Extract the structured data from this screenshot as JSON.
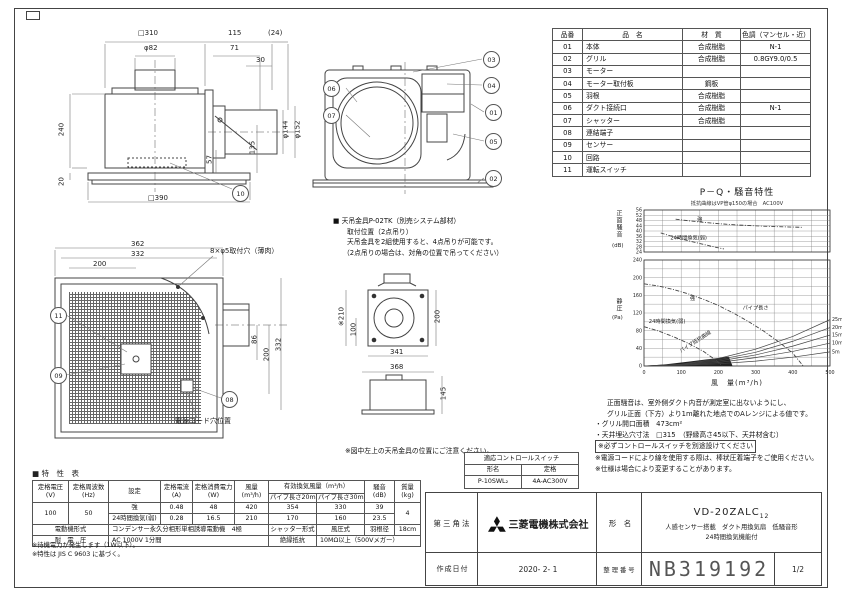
{
  "parts_table": {
    "headers": [
      "品番",
      "品　名",
      "材　質",
      "色調（マンセル・近）"
    ],
    "rows": [
      [
        "01",
        "本体",
        "合成樹脂",
        "N-1"
      ],
      [
        "02",
        "グリル",
        "合成樹脂",
        "0.8GY9.0/0.5"
      ],
      [
        "03",
        "モーター",
        "",
        ""
      ],
      [
        "04",
        "モーター取付板",
        "鋼板",
        ""
      ],
      [
        "05",
        "羽根",
        "合成樹脂",
        ""
      ],
      [
        "06",
        "ダクト接続口",
        "合成樹脂",
        "N-1"
      ],
      [
        "07",
        "シャッター",
        "合成樹脂",
        ""
      ],
      [
        "08",
        "連結端子",
        "",
        ""
      ],
      [
        "09",
        "センサー",
        "",
        ""
      ],
      [
        "10",
        "回路",
        "",
        ""
      ],
      [
        "11",
        "運転スイッチ",
        "",
        ""
      ]
    ]
  },
  "side_view": {
    "dims": {
      "w310": "□310",
      "d82": "φ82",
      "d115": "115",
      "d24": "(24)",
      "d71": "71",
      "d30": "30",
      "h240": "240",
      "h20": "20",
      "w390": "□390",
      "d144": "φ144",
      "d152": "φ152",
      "d57": "57",
      "d135": "135"
    },
    "balloon": "10"
  },
  "section_view": {
    "balloons": [
      "06",
      "07",
      "03",
      "04",
      "01",
      "05",
      "02"
    ]
  },
  "bracket_note": {
    "line1": "■ 天吊金具P-02TK（別売システム部材）",
    "line2": "取付位置（2点吊り）",
    "line3": "天吊金具を2組使用すると、4点吊りが可能です。",
    "line4": "（2点吊りの場合は、対角の位置で吊ってください）"
  },
  "grille_view": {
    "dims": {
      "d362": "362",
      "d332": "332",
      "d200": "200",
      "holes": "8×φ5取付穴（薄肉）",
      "r86": "86",
      "r200": "200",
      "r332": "332"
    },
    "balloons": [
      "11",
      "09",
      "08"
    ],
    "cord_note": "電源コード穴位置"
  },
  "top_view": {
    "dims": {
      "d210": "※210",
      "d100": "100",
      "d200": "200",
      "d341": "341",
      "d368": "368",
      "d145": "145"
    },
    "note": "※図中左上の天吊金具の位置にご注意ください。"
  },
  "pq_chart": {
    "chart_data": [
      {
        "type": "line",
        "title": "P－Q・騒音特性",
        "subtitle": "抵抗曲線はVP管φ150の場合　AC100V",
        "ylabel": "正面騒音",
        "ylabel_unit": "(dB)",
        "xlim": [
          0,
          500
        ],
        "ylim": [
          24,
          56
        ],
        "yticks": [
          56,
          52,
          48,
          44,
          40,
          36,
          32,
          28,
          24
        ],
        "grid": true,
        "series": [
          {
            "name": "強",
            "dash": true,
            "label_at": [
              150,
              47.8
            ],
            "points": [
              [
                85,
                49
              ],
              [
                120,
                47.8
              ],
              [
                160,
                46.6
              ],
              [
                200,
                45.6
              ],
              [
                240,
                44.8
              ],
              [
                280,
                44.2
              ],
              [
                320,
                43.7
              ],
              [
                360,
                43.3
              ],
              [
                400,
                43
              ],
              [
                425,
                42.8
              ]
            ]
          },
          {
            "name": "24時間換気(弱)",
            "dash": true,
            "label_at": [
              120,
              33.5
            ],
            "points": [
              [
                45,
                38.5
              ],
              [
                80,
                35.5
              ],
              [
                120,
                32.5
              ],
              [
                160,
                29.8
              ],
              [
                195,
                27.5
              ],
              [
                215,
                26.3
              ]
            ]
          }
        ]
      },
      {
        "type": "line",
        "ylabel": "静圧",
        "ylabel_unit": "(Pa)",
        "xlabel": "風　量(m³/h)",
        "xlim": [
          0,
          500
        ],
        "ylim": [
          0,
          240
        ],
        "yticks": [
          0,
          40,
          80,
          120,
          160,
          200,
          240
        ],
        "xticks": [
          0,
          100,
          200,
          300,
          400,
          500
        ],
        "grid": true,
        "series": [
          {
            "name": "強",
            "dash": true,
            "label_at": [
              130,
              150
            ],
            "points": [
              [
                0,
                186
              ],
              [
                40,
                181
              ],
              [
                80,
                173
              ],
              [
                120,
                163
              ],
              [
                160,
                151
              ],
              [
                200,
                137
              ],
              [
                240,
                120
              ],
              [
                280,
                101
              ],
              [
                320,
                80
              ],
              [
                360,
                56
              ],
              [
                400,
                29
              ],
              [
                428,
                0
              ]
            ]
          },
          {
            "name": "24時間換気(弱)",
            "dash": true,
            "label_at": [
              62,
              97
            ],
            "points": [
              [
                0,
                89
              ],
              [
                40,
                79
              ],
              [
                80,
                66
              ],
              [
                120,
                51
              ],
              [
                160,
                33
              ],
              [
                195,
                12
              ],
              [
                210,
                0
              ]
            ]
          },
          {
            "name": "5m",
            "pipe": true,
            "points": [
              [
                0,
                0
              ],
              [
                100,
                1.3
              ],
              [
                200,
                5
              ],
              [
                300,
                11
              ],
              [
                400,
                20
              ],
              [
                500,
                32
              ]
            ]
          },
          {
            "name": "10m",
            "pipe": true,
            "points": [
              [
                0,
                0
              ],
              [
                100,
                2
              ],
              [
                200,
                8
              ],
              [
                300,
                19
              ],
              [
                400,
                33
              ],
              [
                500,
                52
              ]
            ]
          },
          {
            "name": "15m",
            "pipe": true,
            "points": [
              [
                0,
                0
              ],
              [
                100,
                3
              ],
              [
                200,
                11
              ],
              [
                300,
                25
              ],
              [
                400,
                45
              ],
              [
                500,
                70
              ]
            ]
          },
          {
            "name": "20m",
            "pipe": true,
            "points": [
              [
                0,
                0
              ],
              [
                100,
                3.5
              ],
              [
                200,
                14
              ],
              [
                300,
                31
              ],
              [
                400,
                56
              ],
              [
                500,
                87
              ]
            ]
          },
          {
            "name": "25m",
            "pipe": true,
            "points": [
              [
                0,
                0
              ],
              [
                100,
                4
              ],
              [
                200,
                17
              ],
              [
                300,
                38
              ],
              [
                400,
                67
              ],
              [
                500,
                105
              ]
            ]
          }
        ],
        "shade": [
          [
            0,
            0
          ],
          [
            60,
            4
          ],
          [
            120,
            10
          ],
          [
            180,
            16
          ],
          [
            228,
            21
          ],
          [
            238,
            0
          ]
        ],
        "annotations": [
          {
            "text": "パイプ長さ",
            "at": [
              300,
              128
            ]
          },
          {
            "text": "パイプ抵抗曲線",
            "at": [
              140,
              52
            ],
            "rotate": -33
          }
        ]
      }
    ]
  },
  "pq_notes": {
    "line1": "正面騒音は、室外側ダクト内音が測定室に出ないようにし、",
    "line2": "グリル正面（下方）より1m離れた地点でのAレンジによる値です。",
    "line3": "・グリル開口面積　473cm²",
    "line4": "・天井埋込穴寸法　□315　（野縁高さ45以下、天井材含む）",
    "line5": "※必ずコントロールスイッチを別途設けてください",
    "line6": "※電源コードにより線を使用する際は、棒状圧着端子をご使用ください。",
    "line7": "※仕様は場合により変更することがあります。"
  },
  "control_switch_table": {
    "title": "適応コントロールスイッチ",
    "col1": "形名",
    "col2": "定格",
    "model": "P-10SWL₂",
    "rating": "4A-AC300V"
  },
  "spec_table": {
    "title": "■ 特　性　表",
    "col_headers": [
      {
        "t": "定格電圧",
        "u": "(V)"
      },
      {
        "t": "定格周波数",
        "u": "(Hz)"
      },
      {
        "t": "設定",
        "u": ""
      },
      {
        "t": "定格電流",
        "u": "(A)"
      },
      {
        "t": "定格消費電力",
        "u": "(W)"
      },
      {
        "t": "風量",
        "u": "(m³/h)"
      },
      {
        "t": "騒音",
        "u": "(dB)"
      },
      {
        "t": "質量",
        "u": "(kg)"
      }
    ],
    "vent_header": "有効換気風量（m³/h）",
    "vent_subs": [
      "パイプ長さ20m時",
      "パイプ長さ30m時"
    ],
    "rows": [
      [
        "100",
        "50",
        "強",
        "0.48",
        "48",
        "420",
        "354",
        "330",
        "39",
        "4"
      ],
      [
        "24時間換気(弱)",
        "0.28",
        "16.5",
        "210",
        "170",
        "160",
        "23.5"
      ]
    ],
    "motor_row": [
      "電動機形式",
      "コンデンサー永久分相形単相誘導電動機　4極",
      "シャッター形式",
      "風圧式",
      "羽根径",
      "18cm"
    ],
    "hv_row": [
      "耐　電　圧",
      "AC 1000V 1分間",
      "絶縁抵抗",
      "10MΩ以上（500Vメガー）"
    ],
    "notes": [
      "※待機電力が発生します（1W以下）。",
      "※特性は JIS C 9603 に基づく。"
    ]
  },
  "title_block": {
    "projection": "第三角法",
    "company": "三菱電機株式会社",
    "model_label": "形　名",
    "model": "VD-20ZALC",
    "model_sub": "12",
    "model_desc1": "人感センサー搭載　ダクト用換気扇　低騒音形",
    "model_desc2": "24時間換気機能付",
    "date_label": "作成日付",
    "date": "2020- 2- 1",
    "number_label": "整理番号",
    "number": "NB319192",
    "page": "1/2"
  }
}
